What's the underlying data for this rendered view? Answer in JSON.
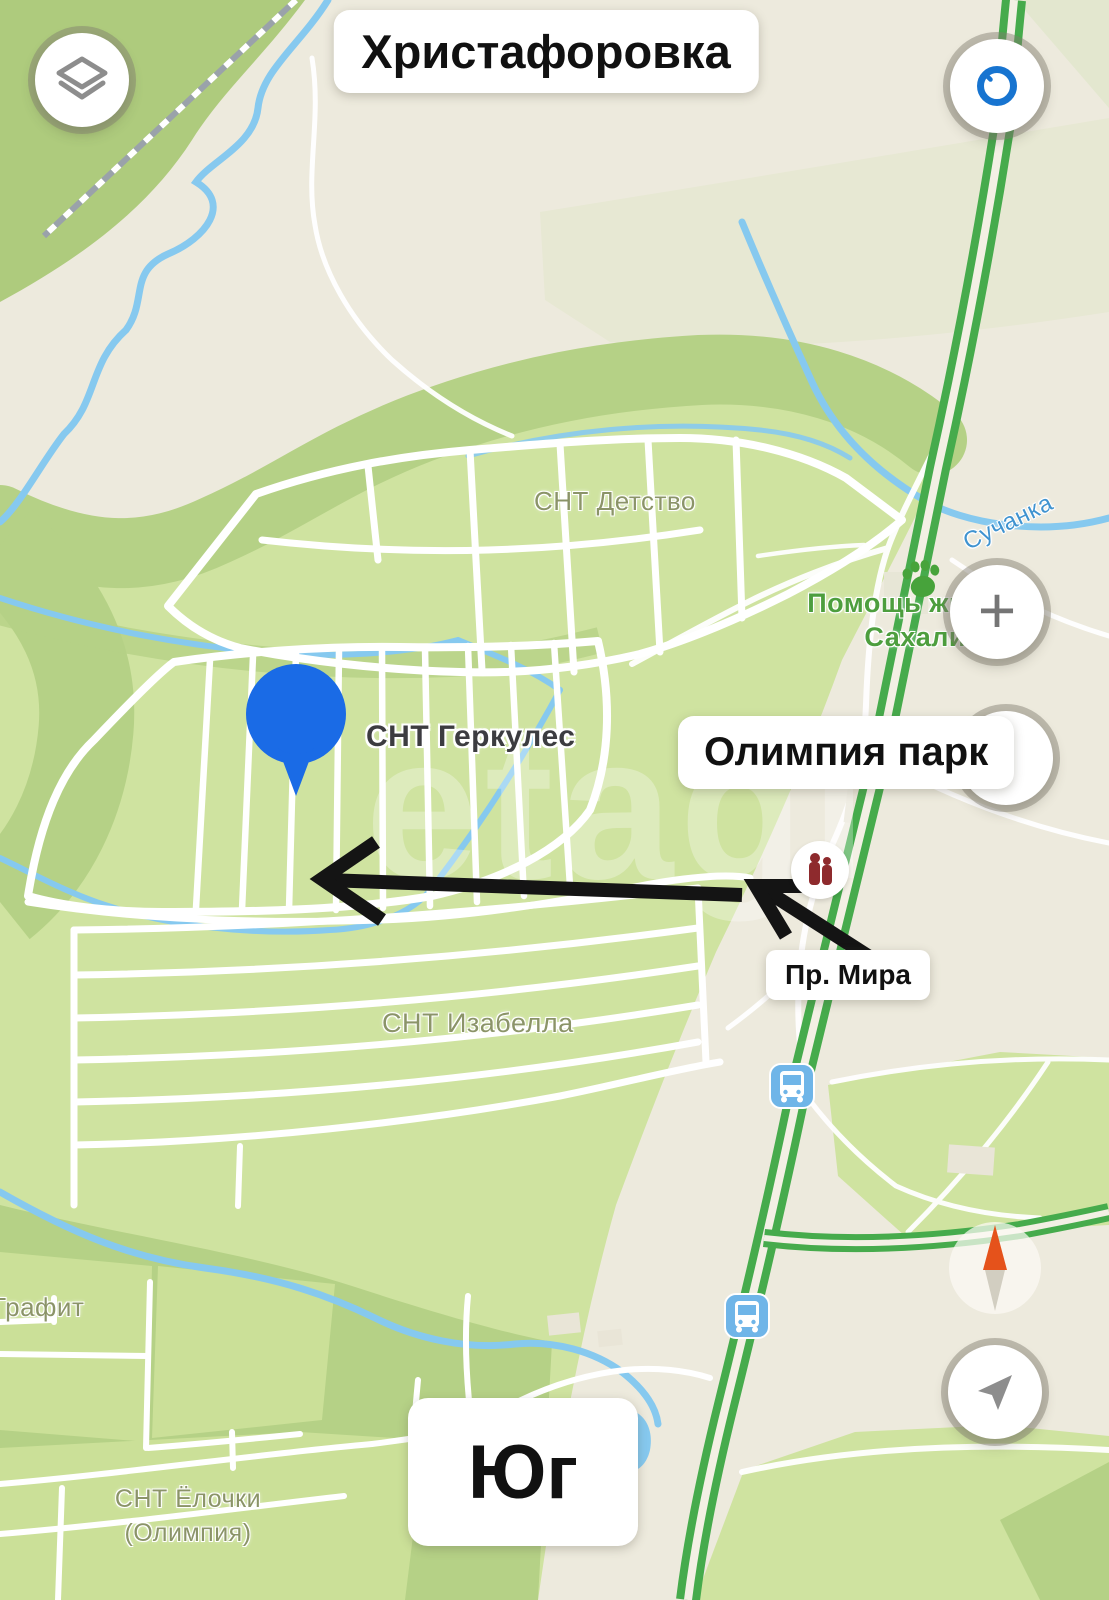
{
  "badges": {
    "title": "Христафоровка",
    "olimpia_park": "Олимпия парк",
    "pr_mira": "Пр. Мира",
    "yug": "Юг"
  },
  "map_labels": {
    "snt_detstvo": "СНТ Детство",
    "snt_gerkules": "СНТ Геркулес",
    "snt_izabella": "СНТ Изабелла",
    "grafit": "Графит",
    "yolochki_line1": "СНТ Ёлочки",
    "yolochki_line2": "(Олимпия)",
    "pomosh_line1": "Помощь жи",
    "pomosh_line2": "Сахали",
    "suchanka": "Сучанка"
  },
  "controls": {
    "zoom_in_glyph": "+"
  },
  "watermark": "etagi",
  "colors": {
    "background": "#edeadd",
    "field_green": "#cfe3a0",
    "forest_green": "#b5d186",
    "highway_green": "#46ab4c",
    "river_blue": "#86c9ef",
    "pin_blue": "#1a6be6",
    "arrow_black": "#141414",
    "label_olive": "#8b9468",
    "poi_green": "#4d9e3e",
    "water_label_blue": "#3f93d0",
    "bus_icon_blue": "#6fb5e8",
    "monument_red": "#8e2a2d",
    "compass_orange": "#e5521b",
    "badge_bg": "#ffffff",
    "badge_text": "#111111"
  }
}
